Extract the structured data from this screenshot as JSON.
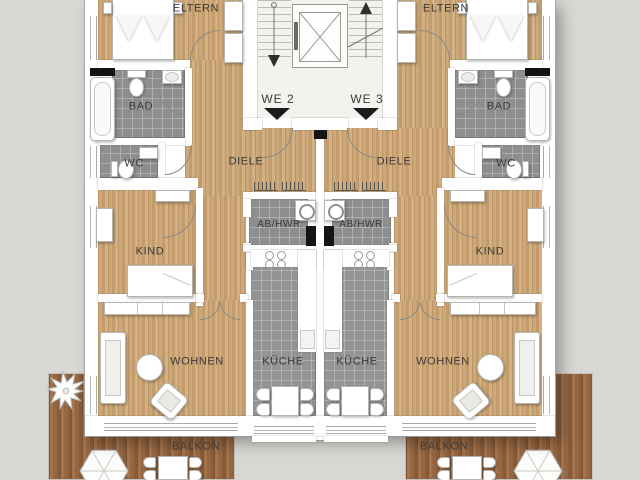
{
  "floor_plan": {
    "units": {
      "we2": {
        "label": "WE 2"
      },
      "we3": {
        "label": "WE 3"
      }
    },
    "room_labels": {
      "eltern": "ELTERN",
      "bad": "BAD",
      "wc": "WC",
      "diele": "DIELE",
      "kind": "KIND",
      "wohnen": "WOHNEN",
      "kueche": "KÜCHE",
      "ab_hwr": "AB/HWR",
      "balkon": "BALKON"
    },
    "colors": {
      "background": "#d8d7d3",
      "wall": "#ffffff",
      "wood_floor": "#c6a171",
      "deck_wood": "#996a44",
      "bath_tile": "#8e8e8f",
      "kitchen_tile": "#949492",
      "shaft": "#141414",
      "entrance_arrow": "#1b1b1b",
      "text": "#3b3b3b"
    },
    "icons": {
      "tree": "tree-icon",
      "parasol": "parasol-icon",
      "elevator": "elevator-icon",
      "stairs": "stairs-icon",
      "radiator": "radiator-icon"
    }
  }
}
